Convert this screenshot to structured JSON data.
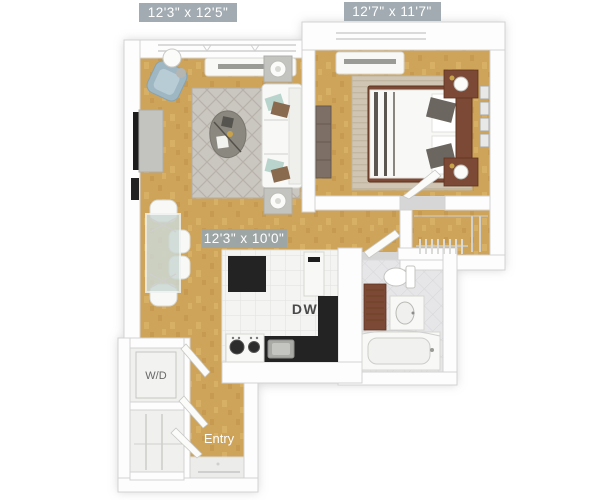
{
  "floorplan": {
    "badges": [
      {
        "room": "living-room",
        "text": "12'3\" x 12'5\""
      },
      {
        "room": "bedroom",
        "text": "12'7\" x 11'7\""
      },
      {
        "room": "living-dining",
        "text": "12'3\" x 10'0\""
      }
    ],
    "labels": {
      "dishwasher": "DW",
      "washer_dryer": "W/D",
      "entry": "Entry"
    },
    "colors": {
      "floor_wood": "#cda45a",
      "wall": "#fdfdfd",
      "wall_edge": "#d2d2d2",
      "shadow": "#bcbcbc",
      "badge_bg": "#9aa5ab",
      "badge_text": "#ffffff",
      "kitchen_tile": "#f4f4f2",
      "counter": "#232323",
      "bath_tile": "#e6e6e8",
      "rug_living": "#cac6c0",
      "rug_bedroom": "#cfc5b2",
      "wood_dark": "#7b4936",
      "armchair": "#9fb7c2",
      "label_text_dark": "#4a4a4a",
      "label_text_light": "#ffffff"
    }
  }
}
